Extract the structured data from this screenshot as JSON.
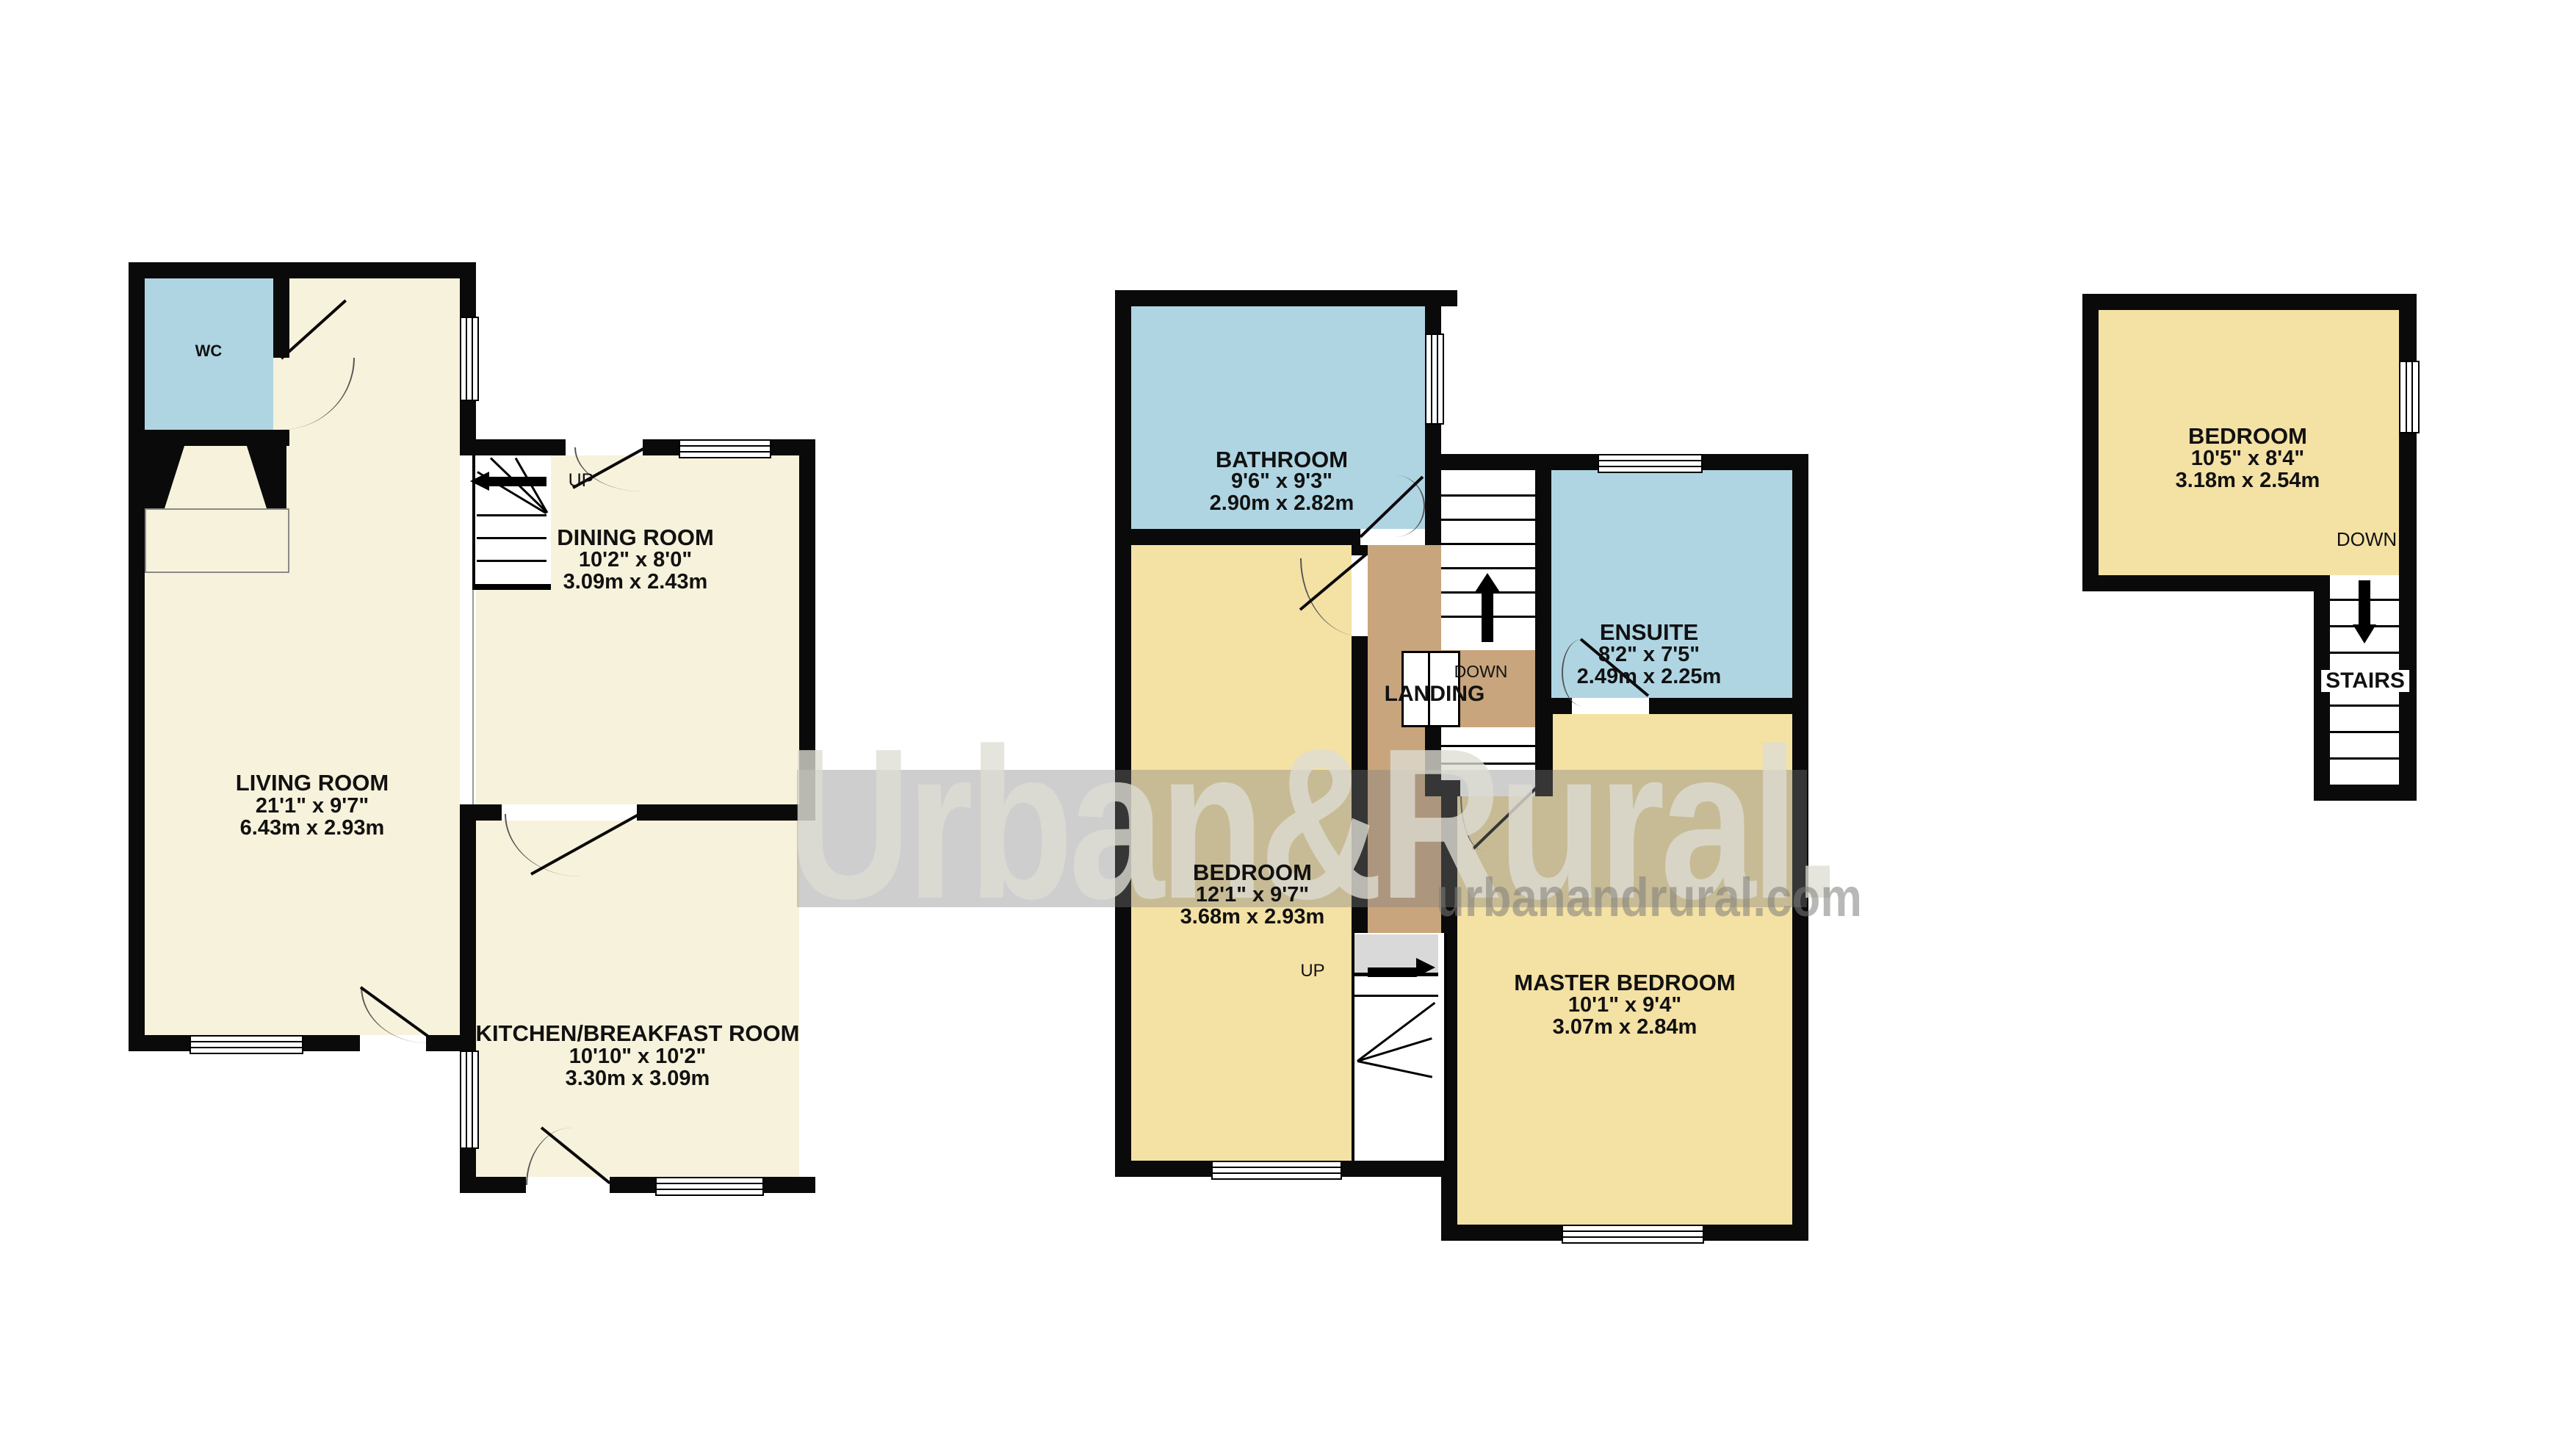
{
  "brand": {
    "logo_text": "Urban&Rural.",
    "website": "urbanandrural.com"
  },
  "floors": [
    {
      "name": "ground-floor",
      "rooms": [
        {
          "key": "wc",
          "label": "WC"
        },
        {
          "key": "living-room",
          "label": "LIVING ROOM",
          "size_imperial": "21'1\"  x 9'7\"",
          "size_metric": "6.43m  x 2.93m"
        },
        {
          "key": "dining-room",
          "label": "DINING ROOM",
          "size_imperial": "10'2\"  x 8'0\"",
          "size_metric": "3.09m  x 2.43m"
        },
        {
          "key": "kitchen-breakfast-room",
          "label": "KITCHEN/BREAKFAST ROOM",
          "size_imperial": "10'10\"  x 10'2\"",
          "size_metric": "3.30m  x 3.09m"
        }
      ],
      "stairs": {
        "up_label": "UP"
      }
    },
    {
      "name": "first-floor",
      "rooms": [
        {
          "key": "bathroom",
          "label": "BATHROOM",
          "size_imperial": "9'6\"  x 9'3\"",
          "size_metric": "2.90m  x 2.82m"
        },
        {
          "key": "bedroom",
          "label": "BEDROOM",
          "size_imperial": "12'1\"  x 9'7\"",
          "size_metric": "3.68m  x 2.93m"
        },
        {
          "key": "ensuite",
          "label": "ENSUITE",
          "size_imperial": "8'2\"  x 7'5\"",
          "size_metric": "2.49m  x 2.25m"
        },
        {
          "key": "master-bedroom",
          "label": "MASTER BEDROOM",
          "size_imperial": "10'1\"  x 9'4\"",
          "size_metric": "3.07m  x 2.84m"
        },
        {
          "key": "landing",
          "label": "LANDING"
        }
      ],
      "stairs": {
        "up_label": "UP",
        "down_label": "DOWN"
      }
    },
    {
      "name": "second-floor",
      "rooms": [
        {
          "key": "bedroom",
          "label": "BEDROOM",
          "size_imperial": "10'5\"  x 8'4\"",
          "size_metric": "3.18m  x 2.54m"
        }
      ],
      "stairs": {
        "down_label": "DOWN",
        "stairs_label": "STAIRS"
      }
    }
  ],
  "colors": {
    "room_cream": "#F7F2DB",
    "room_yellow": "#F4E1A4",
    "room_blue": "#AFD5E3",
    "landing_brown": "#C8A57C",
    "wall_black": "#0A0A0A",
    "watermark_gray": "#7F7F7F"
  }
}
